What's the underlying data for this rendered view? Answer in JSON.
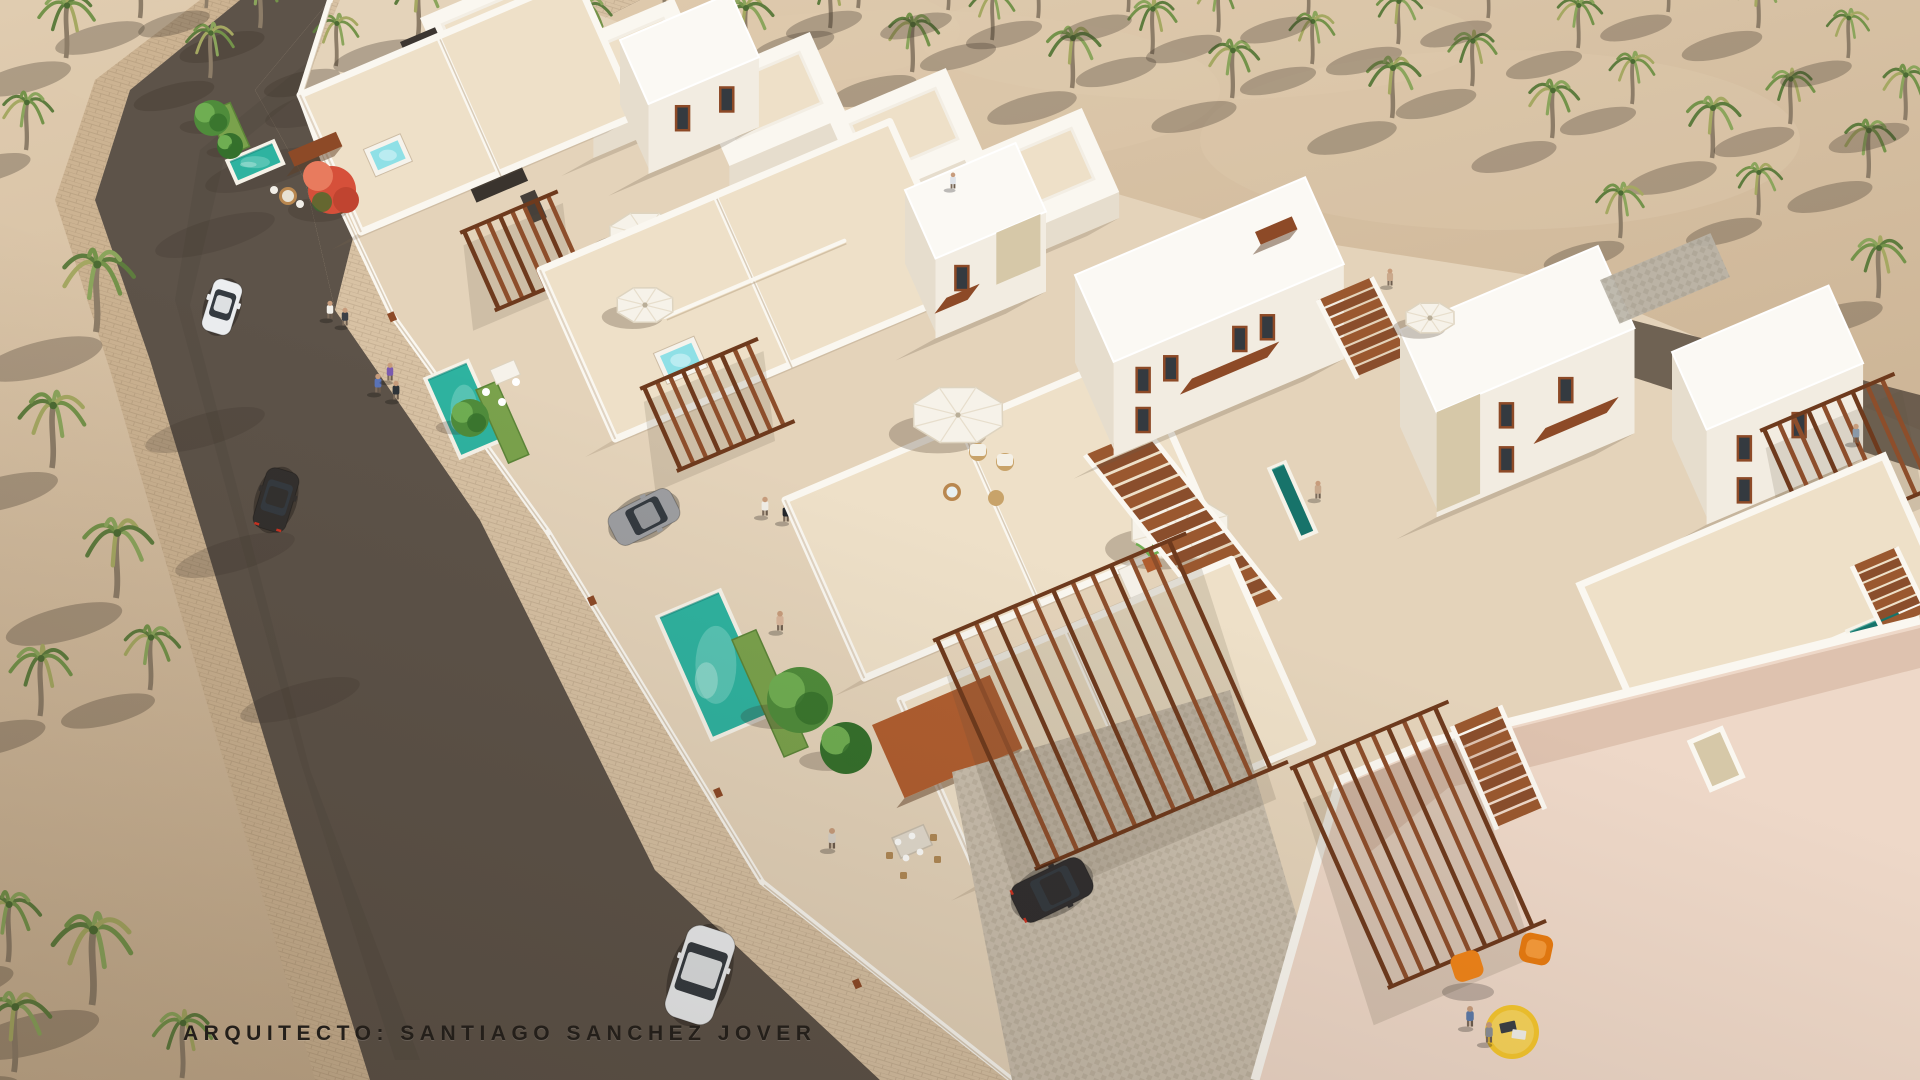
{
  "caption": {
    "text": "ARQUITECTO: SANTIAGO SANCHEZ JOVER"
  },
  "scene": {
    "type": "architectural-aerial-3d-render",
    "description": "Daytime aerial rendering of a white Mediterranean villa development with rooftop terraces, private pools and jacuzzis, wooden pergolas and stairs, a palm grove, a street with sidewalks, cars and pedestrians",
    "objects": {
      "villas": "white flat-roofed villas with roof terraces and two-story blocks",
      "pools": 4,
      "jacuzzis": 3,
      "parasols": 6,
      "cars": 5,
      "people": 16,
      "palm_trees": "dense palm grove on sand",
      "furniture": "orange chairs, yellow round table, white sun loungers, wicker lounge set, outdoor dining tables",
      "pergolas": "brown slatted timber pergolas, carport and exterior stairs"
    }
  },
  "palette": {
    "sand": "#d2bb9d",
    "sand_bright": "#e0ccb0",
    "sand_shadow": "#8e7a63",
    "road": "#5d5349",
    "road_dark": "#4c443c",
    "sidewalk": "#ccb392",
    "dev_floor": "#e4d3ba",
    "terrace": "#eee0c8",
    "pink_tile": "#eed8c8",
    "cobble": "#c9bead",
    "gravel": "#b8b2a6",
    "white": "#faf7f0",
    "white_shade": "#e6ddcd",
    "wall_dark": "#cdbca4",
    "stone": "#d6c8a8",
    "pool": "#2eb3a0",
    "pool_light": "#7fd6c8",
    "pool_dark": "#14897c",
    "lap_pool": "#17736a",
    "jacuzzi": "#8fe0e6",
    "jacuzzi_light": "#c8f0f4",
    "grass": "#7aa24c",
    "grass_dark": "#5c8538",
    "tree": "#4f8c3b",
    "tree_dark": "#35702c",
    "tree_light": "#6fae52",
    "red_tree": "#d6503a",
    "red_tree_light": "#e87b5e",
    "pergola": "#8d4e2b",
    "pergola_dark": "#6e3a1d",
    "awning": "#8d4a27",
    "awning_bright": "#b05e30",
    "stair": "#8a4e2c",
    "car_white": "#eceef0",
    "car_dark": "#302e2f",
    "car_gray": "#9d9ea1",
    "glass": "#343a40",
    "taillight": "#cc3322",
    "chair_orange": "#f08418",
    "table_yellow": "#f5c62e",
    "umbrella": "#f6f2e9",
    "umbrella_edge": "#ded4c0",
    "palm_a": "#5e7c3e",
    "palm_b": "#74934a",
    "palm_c": "#8ba55c",
    "palm_d": "#a5a862",
    "trunk": "#8d7d68",
    "shadow": "#3a3127",
    "skin": "#c79c7c",
    "caption_color": "#241f1a"
  }
}
